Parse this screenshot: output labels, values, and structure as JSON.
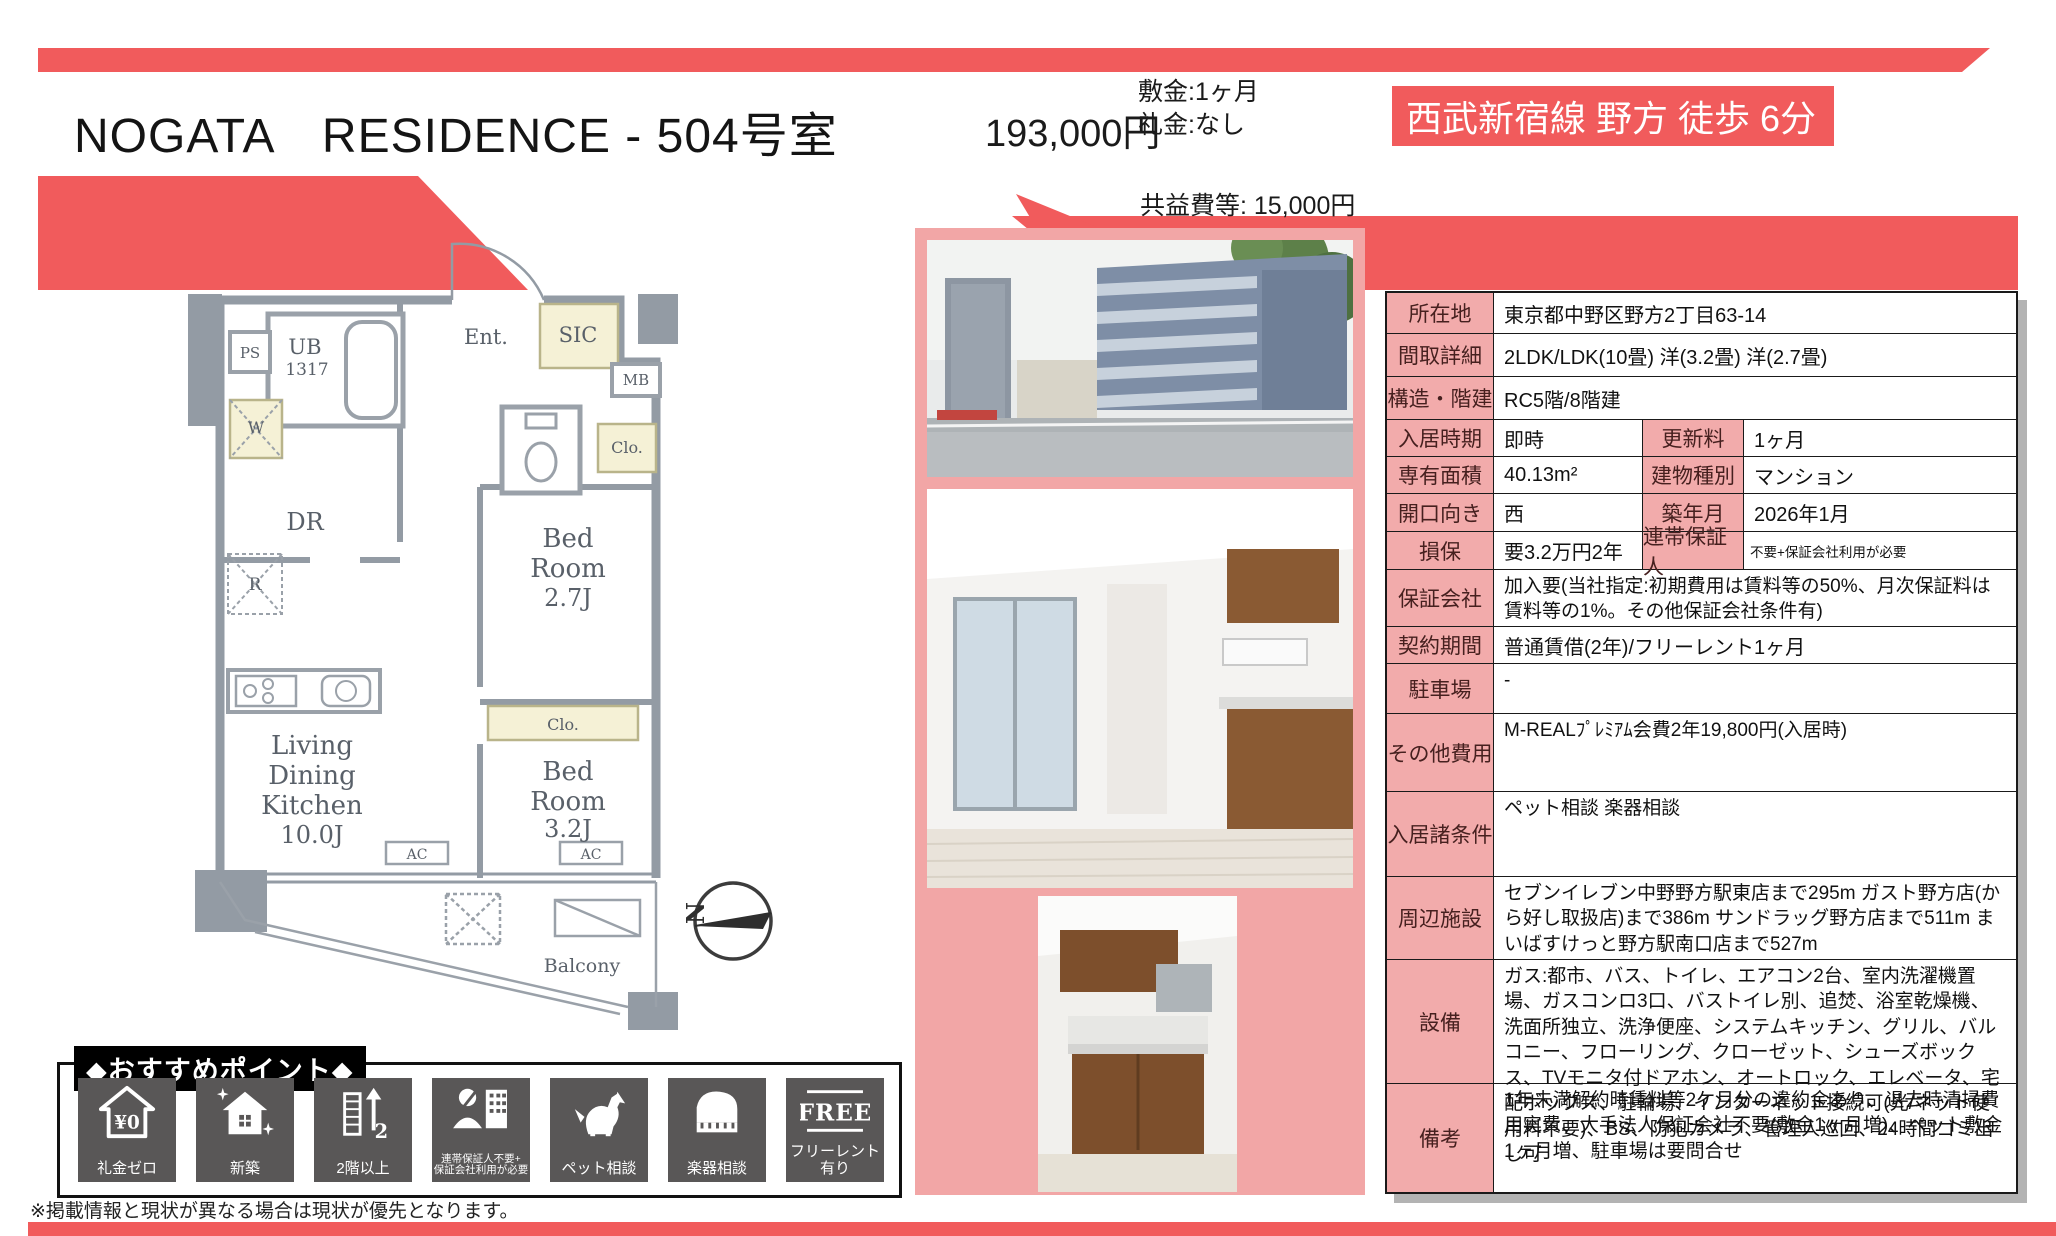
{
  "colors": {
    "accent_red": "#f15b5c",
    "panel_pink": "#f2a6a6",
    "cell_pink": "#f2abab",
    "icon_gray": "#595757"
  },
  "header": {
    "title": "NOGATA　RESIDENCE - 504号室",
    "rent": "193,000円",
    "deposit": "敷金:1ヶ月",
    "key_money": "礼金:なし",
    "common_fee": "共益費等: 15,000円",
    "station": "西武新宿線 野方 徒歩 6分"
  },
  "table": {
    "location": {
      "label": "所在地",
      "value": "東京都中野区野方2丁目63-14"
    },
    "layout_detail": {
      "label": "間取詳細",
      "value": "2LDK/LDK(10畳) 洋(3.2畳) 洋(2.7畳)"
    },
    "structure": {
      "label": "構造・階建",
      "value": "RC5階/8階建"
    },
    "move_in": {
      "label": "入居時期",
      "value": "即時"
    },
    "renewal_fee": {
      "label": "更新料",
      "value": "1ヶ月"
    },
    "area": {
      "label": "専有面積",
      "value": "40.13m²"
    },
    "building_type": {
      "label": "建物種別",
      "value": "マンション"
    },
    "facing": {
      "label": "開口向き",
      "value": "西"
    },
    "built": {
      "label": "築年月",
      "value": "2026年1月"
    },
    "insurance": {
      "label": "損保",
      "value": "要3.2万円2年"
    },
    "guarantor": {
      "label": "連帯保証人",
      "value": "不要+保証会社利用が必要"
    },
    "guarantee_company": {
      "label": "保証会社",
      "value": "加入要(当社指定:初期費用は賃料等の50%、月次保証料は賃料等の1%。その他保証会社条件有)"
    },
    "contract": {
      "label": "契約期間",
      "value": "普通賃借(2年)/フリーレント1ヶ月"
    },
    "parking": {
      "label": "駐車場",
      "value": "-"
    },
    "other_fees": {
      "label": "その他費用",
      "value": "M-REALﾌﾟﾚﾐｱﾑ会費2年19,800円(入居時)"
    },
    "conditions": {
      "label": "入居諸条件",
      "value": "ペット相談 楽器相談"
    },
    "nearby": {
      "label": "周辺施設",
      "value": "セブンイレブン中野野方駅東店まで295m ガスト野方店(から好し取扱店)まで386m サンドラッグ野方店まで511m まいばすけっと野方駅南口店まで527m"
    },
    "equipment": {
      "label": "設備",
      "value": "ガス:都市、バス、トイレ、エアコン2台、室内洗濯機置場、ガスコンロ3口、バストイレ別、追焚、浴室乾燥機、洗面所独立、洗浄便座、システムキッチン、グリル、バルコニー、フローリング、クローゼット、シューズボックス、TVモニタ付ドアホン、オートロック、エレベータ、宅配ボックス、駐輪場、インターネット接続可(光/ネット使用料不要)、BS、防犯カメラ、管理人巡回、24時間ゴミ出し可"
    },
    "remarks": {
      "label": "備考",
      "value": "1年未満解約時賃料等2ケ月分の違約金あり、退去時清掃費用実費、大手法人保証会社不要(敷金1ヶ月増)、ペット敷金1ヶ月増、駐車場は要問合せ"
    }
  },
  "floorplan": {
    "labels": {
      "ps": "PS",
      "ub": [
        "UB",
        "1317"
      ],
      "w": "W",
      "dr": "DR",
      "r": "R",
      "ent": "Ent.",
      "sic": "SIC",
      "mb": "MB",
      "clo_hall": "Clo.",
      "bed1": [
        "Bed",
        "Room",
        "2.7J"
      ],
      "clo_bed": "Clo.",
      "ldk": [
        "Living",
        "Dining",
        "Kitchen",
        "10.0J"
      ],
      "bed2": [
        "Bed",
        "Room",
        "3.2J"
      ],
      "ac1": "AC",
      "ac2": "AC",
      "balcony": "Balcony",
      "compass_north": "N"
    }
  },
  "points": {
    "header": "◆おすすめポイント◆",
    "items": [
      {
        "label": "礼金ゼロ",
        "icon": "yen-zero-house",
        "icon_text": "¥0"
      },
      {
        "label": "新築",
        "icon": "new-house-sparkle"
      },
      {
        "label": "2階以上",
        "icon": "building-upper-floor",
        "icon_text": "2"
      },
      {
        "label": "連帯保証人不要+\n保証会社利用が必要",
        "icon": "guarantor-company"
      },
      {
        "label": "ペット相談",
        "icon": "pet-dog"
      },
      {
        "label": "楽器相談",
        "icon": "piano"
      },
      {
        "label": "フリーレント有り",
        "icon": "free-rent",
        "icon_text": "FREE"
      }
    ]
  },
  "footer": {
    "note": "※掲載情報と現状が異なる場合は現状が優先となります。"
  }
}
